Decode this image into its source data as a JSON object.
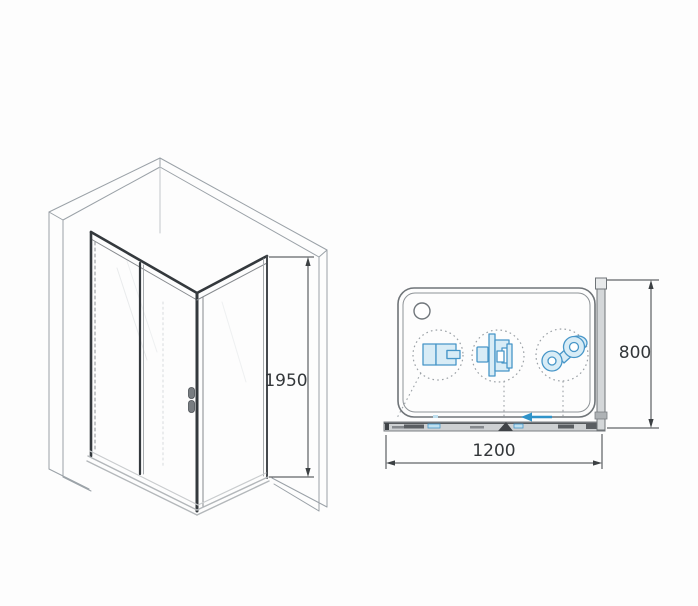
{
  "dimensions": {
    "height": "1950",
    "width": "1200",
    "depth": "800"
  },
  "icons": {
    "drain": "drain-hole-icon",
    "handle": "door-handle-icon",
    "callout_wall_profile": "wall-profile-section-detail-icon",
    "callout_roller_bracket": "roller-bracket-detail-icon",
    "callout_double_roller": "double-roller-detail-icon",
    "slide_arrow": "slide-direction-left-arrow-icon"
  },
  "colors": {
    "background": "#fdfdfd",
    "line_dark": "#34393d",
    "line_light": "#9aa1a7",
    "dimension": "#3c4043",
    "accent_blue": "#4796c8",
    "accent_blue_fill": "#d8ecf6"
  }
}
